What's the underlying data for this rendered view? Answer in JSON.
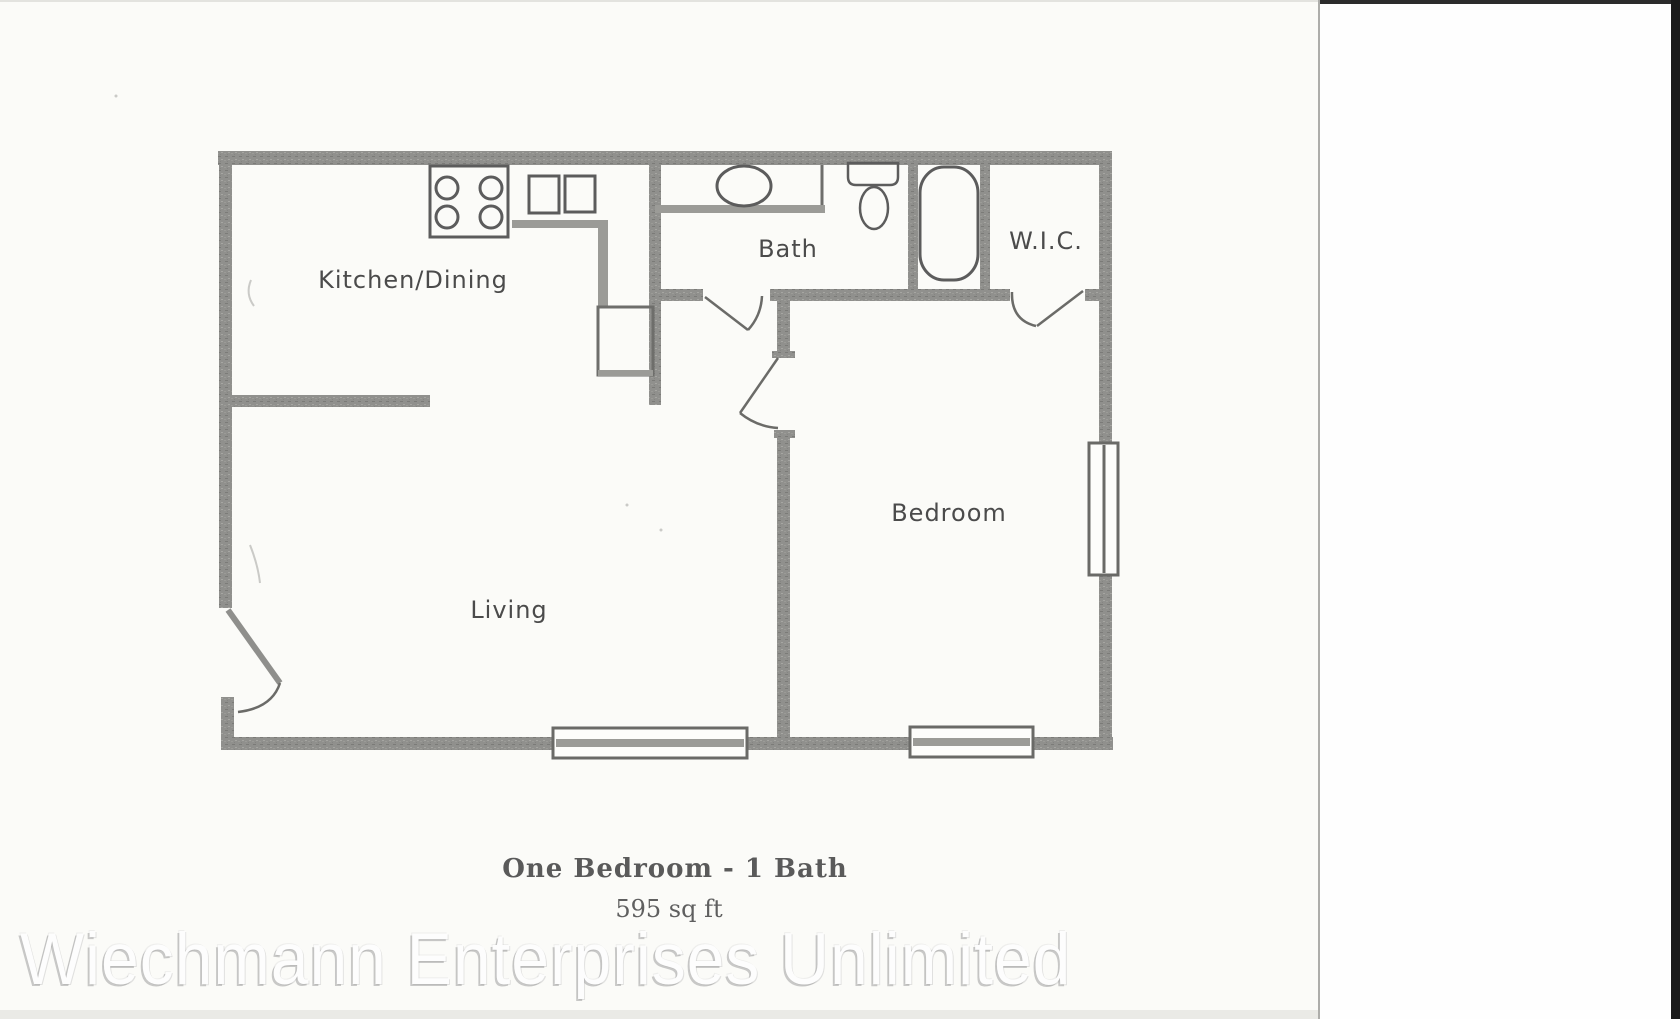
{
  "scan": {
    "watermark_text": "Wiechmann Enterprises Unlimited",
    "page_background": "#fbfbf8",
    "margin_background": "#fefefe",
    "scanner_edge_color": "#1b1b1b"
  },
  "floorplan": {
    "title": "One Bedroom - 1 Bath",
    "area": "595 sq ft",
    "rooms": [
      {
        "name": "kitchen-dining",
        "label": "Kitchen/Dining"
      },
      {
        "name": "bath",
        "label": "Bath"
      },
      {
        "name": "wic",
        "label": "W.I.C."
      },
      {
        "name": "bedroom",
        "label": "Bedroom"
      },
      {
        "name": "living",
        "label": "Living"
      }
    ],
    "fixtures": [
      {
        "name": "stove",
        "burners": 4
      },
      {
        "name": "kitchen-double-sink"
      },
      {
        "name": "kitchen-counter"
      },
      {
        "name": "pantry-closet"
      },
      {
        "name": "bath-vanity-sink"
      },
      {
        "name": "toilet"
      },
      {
        "name": "bathtub"
      },
      {
        "name": "window",
        "count": 3
      },
      {
        "name": "door-swing",
        "count": 4
      }
    ],
    "wall_color": "#90908d",
    "fixture_line_color": "#5c5c5c",
    "label_color": "#4b4b4b"
  }
}
